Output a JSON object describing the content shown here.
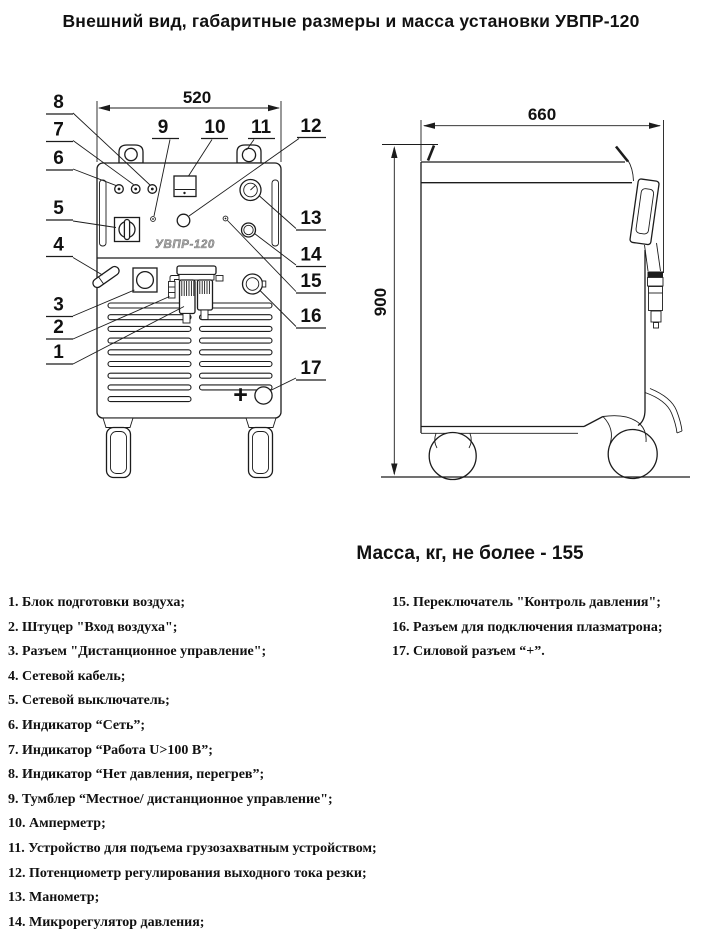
{
  "title": "Внешний вид, габаритные размеры и масса установки УВПР-120",
  "mass_note": "Масса, кг, не более - 155",
  "ink_color": "#1c1c1c",
  "front_view": {
    "width_label": "520",
    "panel_label": "УВПР-120",
    "plus_label": "+",
    "callouts": [
      "1",
      "2",
      "3",
      "4",
      "5",
      "6",
      "7",
      "8",
      "9",
      "10",
      "11",
      "12",
      "13",
      "14",
      "15",
      "16",
      "17"
    ]
  },
  "side_view": {
    "width_label": "660",
    "height_label": "900"
  },
  "legend": {
    "left": [
      {
        "num": "1.",
        "label": "Блок подготовки воздуха;"
      },
      {
        "num": "2.",
        "label": "Штуцер \"Вход воздуха\";"
      },
      {
        "num": "3.",
        "label": "Разъем \"Дистанционное управление\";"
      },
      {
        "num": "4.",
        "label": "Сетевой кабель;"
      },
      {
        "num": "5.",
        "label": "Сетевой выключатель;"
      },
      {
        "num": "6.",
        "label": "Индикатор “Сеть”;"
      },
      {
        "num": "7.",
        "label": "Индикатор “Работа U>100 В”;"
      },
      {
        "num": "8.",
        "label": "Индикатор “Нет давления, перегрев”;"
      },
      {
        "num": "9.",
        "label": "Тумблер “Местное/ дистанционное управление\";"
      },
      {
        "num": "10.",
        "label": "Амперметр;"
      },
      {
        "num": "11.",
        "label": "Устройство для подъема грузозахватным устройством;"
      },
      {
        "num": "12.",
        "label": "Потенциометр регулирования выходного тока резки;"
      },
      {
        "num": "13.",
        "label": "Манометр;"
      },
      {
        "num": "14.",
        "label": "Микрорегулятор давления;"
      }
    ],
    "right": [
      {
        "num": "15.",
        "label": "Переключатель \"Контроль давления\";"
      },
      {
        "num": "16.",
        "label": "Разъем для подключения плазматрона;"
      },
      {
        "num": "17.",
        "label": "Силовой разъем “+”."
      }
    ]
  }
}
